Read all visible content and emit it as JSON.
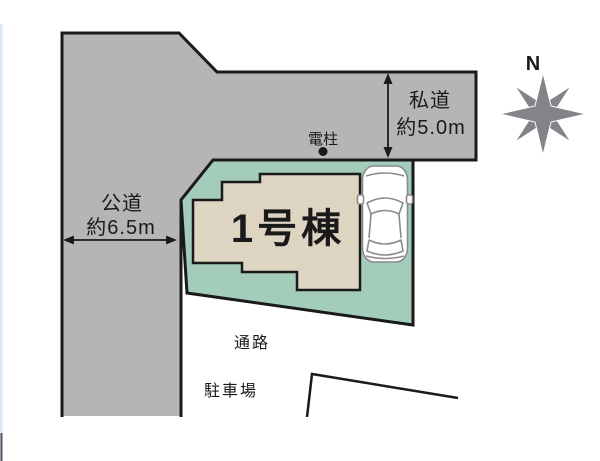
{
  "labels": {
    "building": "1号棟",
    "private_road": "私道",
    "private_road_width": "約5.0m",
    "public_road": "公道",
    "public_road_width": "約6.5m",
    "utility_pole": "電柱",
    "passage": "通路",
    "parking": "駐車場",
    "compass_north": "N"
  },
  "colors": {
    "road": "#b5b5b8",
    "plot": "#a4ccbb",
    "building": "#ddd4c2",
    "outline": "#1a1a1a",
    "compass": "#83838a",
    "car_stroke": "#8a8a8a",
    "edge_strip": "#dce8f5",
    "edge_strip_dark": "#4d5560"
  }
}
